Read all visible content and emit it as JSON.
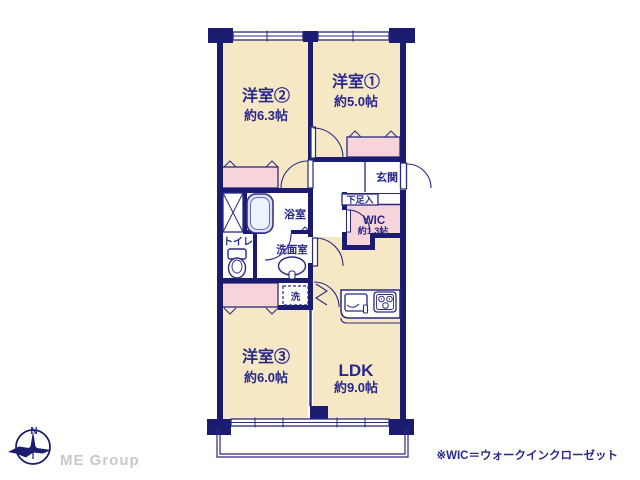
{
  "rooms": {
    "room2": {
      "name": "洋室②",
      "size": "約6.3帖"
    },
    "room1": {
      "name": "洋室①",
      "size": "約5.0帖"
    },
    "room3": {
      "name": "洋室③",
      "size": "約6.0帖"
    },
    "ldk": {
      "name": "LDK",
      "size": "約9.0帖"
    },
    "wic": {
      "name": "WIC",
      "size": "約1.3帖"
    }
  },
  "labels": {
    "genkan": "玄関",
    "shoebox": "下足入",
    "bath": "浴室",
    "toilet": "トイレ",
    "washroom": "洗面室",
    "laundry": "洗",
    "north": "N"
  },
  "footer": {
    "brand": "ME Group",
    "note": "※WIC＝ウォークインクローゼット"
  },
  "colors": {
    "wall": "#1b1b70",
    "text": "#28288c",
    "room_cream": "#f6e8c5",
    "closet_pink": "#f7d4da",
    "bath_blue": "#dbe4f2",
    "brand_gray": "#c8c8c8"
  }
}
